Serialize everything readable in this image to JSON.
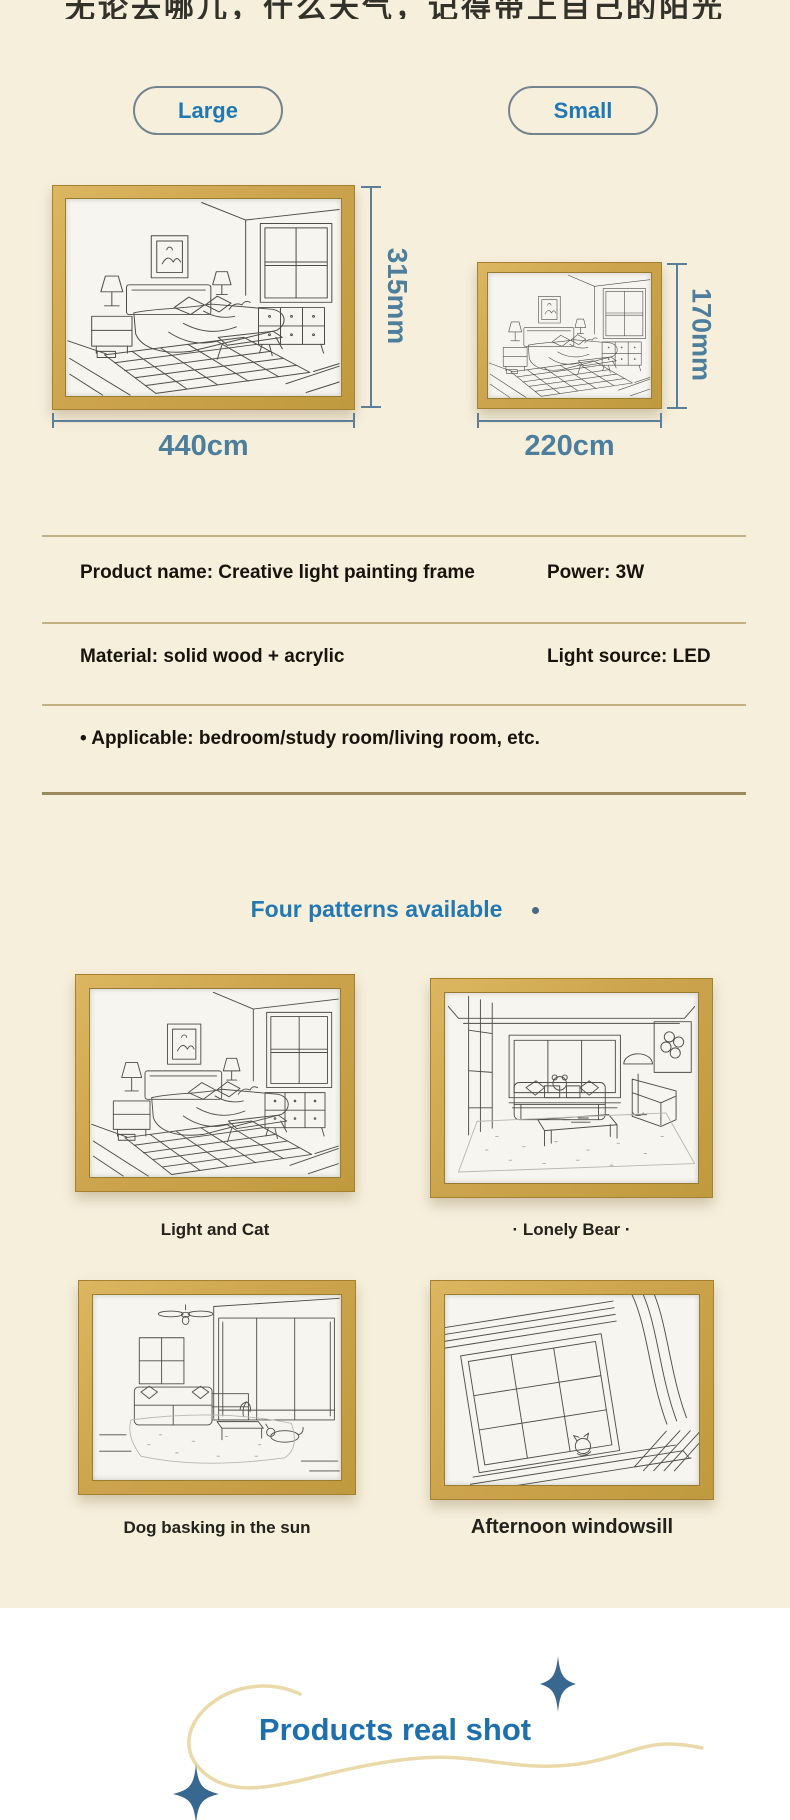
{
  "colors": {
    "background": "#f6efdc",
    "bottom_background": "#ffffff",
    "accent_blue": "#2478b2",
    "dimension_blue": "#4d7e9b",
    "button_text_blue": "#1f78b4",
    "wood_frame": "#cda44e",
    "divider_tan": "#c2b183",
    "spec_text": "#17130d"
  },
  "top_caption": {
    "text": "无论去哪儿，什么天气，记得带上自己的阳光"
  },
  "size_buttons": [
    {
      "label": "Large"
    },
    {
      "label": "Small"
    }
  ],
  "size_diagram": {
    "large": {
      "height_label": "315mm",
      "width_label": "440cm"
    },
    "small": {
      "height_label": "170mm",
      "width_label": "220cm"
    }
  },
  "specs": {
    "rows": [
      {
        "left": "Product name: Creative light painting frame",
        "right": "Power: 3W"
      },
      {
        "left": "Material: solid wood + acrylic",
        "right": "Light source: LED"
      },
      {
        "left": "•  Applicable: bedroom/study room/living room, etc.",
        "right": ""
      }
    ]
  },
  "patterns": {
    "heading": "Four patterns available",
    "items": [
      {
        "name": "Light and Cat"
      },
      {
        "name": "· Lonely Bear ·"
      },
      {
        "name": "Dog basking in the sun"
      },
      {
        "name": "Afternoon windowsill"
      }
    ]
  },
  "real_shot": {
    "title": "Products real shot"
  }
}
